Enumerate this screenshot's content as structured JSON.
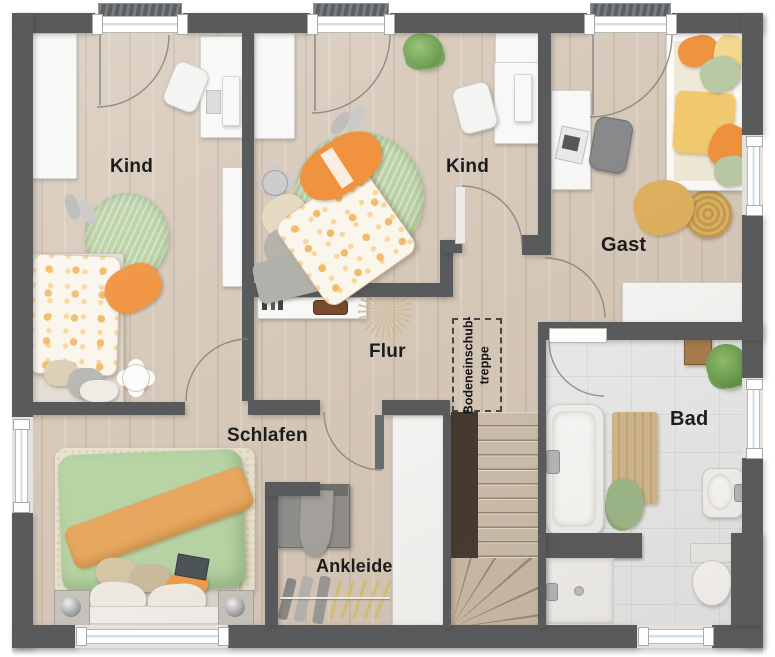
{
  "rooms": {
    "kind_left": {
      "label": "Kind"
    },
    "kind_middle": {
      "label": "Kind"
    },
    "gast": {
      "label": "Gast"
    },
    "flur": {
      "label": "Flur"
    },
    "schlafen": {
      "label": "Schlafen"
    },
    "ankleide": {
      "label": "Ankleide"
    },
    "bad": {
      "label": "Bad"
    }
  },
  "annotations": {
    "attic_stairs": {
      "line1": "Bodeneinschub-",
      "line2": "treppe"
    }
  },
  "palette": {
    "wall": "#595a5c",
    "wood_floor": "#d7c9ba",
    "tile_floor": "#eaecee",
    "accent_orange": "#f0923e",
    "accent_green": "#b8d2a2",
    "rug_cream": "#eae2d0",
    "stair_wood": "#cdbfae"
  },
  "objects": [
    "wardrobe",
    "desk",
    "desk-chair",
    "round-rug",
    "single-bed",
    "double-bed",
    "guest-bed",
    "wall-shelf",
    "plant",
    "pampas-grass",
    "flower-side-table",
    "slippers",
    "dresser",
    "clothes-rail",
    "staircase",
    "bathtub",
    "shower",
    "washbasin",
    "toilet",
    "bath-mat",
    "towels",
    "wooden-stool",
    "nightstand",
    "sphere-lamp",
    "sideboard"
  ]
}
